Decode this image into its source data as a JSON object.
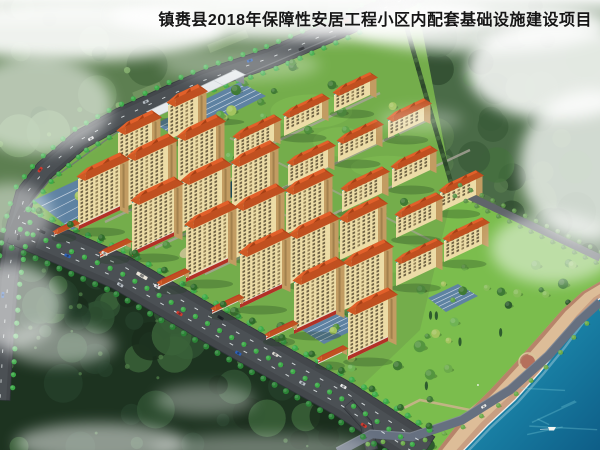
{
  "title": {
    "text": "镇赉县2018年保障性安居工程小区内配套基础设施建设项目"
  },
  "palette": {
    "sky": "#edf1e8",
    "fog": "#ffffff",
    "title_color": "#161616",
    "forest_upper": "#5d7f51",
    "forest_upper_blobs": [
      "#4f7347",
      "#5d8152",
      "#6d9260",
      "#45673e",
      "#79a06a"
    ],
    "forest_right": "#4a6b47",
    "forest_right_blobs": [
      "#3b5c39",
      "#2f4c30",
      "#567b4e",
      "#45703f"
    ],
    "forest_dark": "#1d3320",
    "forest_dark_blobs": [
      "#24402a",
      "#2f5133",
      "#1a2d1c",
      "#3a6138"
    ],
    "terrace": "#91b177",
    "asphalt": "#43474b",
    "asphalt_light": "#54595d",
    "lane": "#e9eef0",
    "street_tree": "#3cab47",
    "street_tree_dark": "#2b8336",
    "lawn": "#74ad4b",
    "lawn_light": "#85c055",
    "park_lawn": "#7cc04e",
    "inner_path": "#aaa59a",
    "tan_path": "#c9b28b",
    "parking": "#5d7fa6",
    "stall": "#d8e0ea",
    "facade": "#ecdca6",
    "facade_end": "#c29c62",
    "window": "#63553a",
    "window_alt": "#8a7850",
    "teal_band": "#2ea396",
    "roof": "#e2602a",
    "roof_side": "#b04518",
    "roof_back": "#c05020",
    "roof_left": "#cf5a24",
    "gable": "#a33f15",
    "podium": "#b23127",
    "shop_roof": "#c23b28",
    "shop_face": "#ded6c8",
    "long_roof": "#e6eaec",
    "long_side": "#9aa0a4",
    "hedge": "#33502f",
    "wall": "#6d7276",
    "water_near": "#5ec7d4",
    "water_mid": "#1a84a8",
    "water_deep": "#0d5a84",
    "sand": "#ddbd98",
    "sand_wet": "#c79b80",
    "sand_top": "#aa725b",
    "shore_road": "#667080",
    "orchard_trees": [
      "#aec973",
      "#93b95c",
      "#c0d687"
    ],
    "site_trees": [
      "#3f7a33",
      "#4f8f3c",
      "#5fa348",
      "#6fb354",
      "#a3c45e"
    ],
    "park_trees": [
      "#3e7a35",
      "#54953f",
      "#6cab4a",
      "#86bd58",
      "#2e5c2e"
    ],
    "car_colors": [
      "#e8e8e8",
      "#d03a2e",
      "#23262b",
      "#2e62b8",
      "#dcd9d2",
      "#b7bec4"
    ]
  },
  "scene": {
    "roads": {
      "main_upper": {
        "path": [
          [
            420,
            -8
          ],
          [
            340,
            28
          ],
          [
            270,
            58
          ],
          [
            205,
            80
          ],
          [
            170,
            95
          ],
          [
            120,
            118
          ],
          [
            80,
            140
          ],
          [
            45,
            170
          ],
          [
            25,
            195
          ],
          [
            16,
            228
          ],
          [
            8,
            280
          ],
          [
            3,
            345
          ],
          [
            0,
            400
          ]
        ],
        "width": 20
      },
      "main_lower": {
        "path": [
          [
            14,
            226
          ],
          [
            120,
            272
          ],
          [
            230,
            336
          ],
          [
            345,
            400
          ],
          [
            425,
            452
          ]
        ],
        "width": 36
      },
      "shore": {
        "path": [
          [
            338,
            452
          ],
          [
            372,
            434
          ],
          [
            412,
            437
          ],
          [
            462,
            420
          ],
          [
            510,
            390
          ],
          [
            548,
            356
          ],
          [
            578,
            322
          ],
          [
            600,
            302
          ]
        ],
        "width": 9
      },
      "orchard": {
        "path": [
          [
            452,
            188
          ],
          [
            520,
            220
          ],
          [
            600,
            258
          ]
        ],
        "width": 7
      },
      "branch": {
        "path": [
          [
            348,
            404
          ],
          [
            366,
            424
          ],
          [
            372,
            450
          ]
        ],
        "width": 12
      }
    },
    "hedge_top": [
      [
        400,
        4
      ],
      [
        430,
        110
      ],
      [
        452,
        186
      ]
    ],
    "wall_line": [
      [
        336,
        36
      ],
      [
        205,
        92
      ],
      [
        120,
        130
      ],
      [
        48,
        182
      ],
      [
        24,
        212
      ]
    ],
    "site_region": [
      [
        415,
        -8
      ],
      [
        340,
        30
      ],
      [
        205,
        82
      ],
      [
        120,
        120
      ],
      [
        45,
        172
      ],
      [
        16,
        226
      ],
      [
        120,
        272
      ],
      [
        230,
        336
      ],
      [
        345,
        400
      ],
      [
        400,
        452
      ],
      [
        470,
        452
      ],
      [
        600,
        296
      ],
      [
        600,
        258
      ],
      [
        500,
        212
      ],
      [
        452,
        186
      ],
      [
        415,
        -8
      ]
    ],
    "forest_upper_poly": [
      [
        0,
        0
      ],
      [
        420,
        0
      ],
      [
        340,
        28
      ],
      [
        205,
        80
      ],
      [
        120,
        118
      ],
      [
        45,
        170
      ],
      [
        16,
        228
      ],
      [
        3,
        345
      ],
      [
        0,
        400
      ]
    ],
    "forest_right_poly": [
      [
        388,
        0
      ],
      [
        600,
        0
      ],
      [
        600,
        256
      ],
      [
        500,
        210
      ],
      [
        452,
        190
      ],
      [
        398,
        4
      ]
    ],
    "forest_dark_poly": [
      [
        0,
        232
      ],
      [
        14,
        236
      ],
      [
        120,
        282
      ],
      [
        230,
        346
      ],
      [
        340,
        412
      ],
      [
        392,
        452
      ],
      [
        0,
        452
      ]
    ],
    "water_shoreline": [
      [
        462,
        452
      ],
      [
        488,
        425
      ],
      [
        515,
        400
      ],
      [
        540,
        372
      ],
      [
        562,
        345
      ],
      [
        582,
        318
      ],
      [
        598,
        300
      ],
      [
        612,
        290
      ]
    ],
    "beach_inner": [
      [
        436,
        452
      ],
      [
        462,
        418
      ],
      [
        490,
        390
      ],
      [
        516,
        362
      ],
      [
        540,
        335
      ],
      [
        562,
        310
      ],
      [
        582,
        292
      ],
      [
        606,
        278
      ]
    ],
    "towers": [
      [
        78,
        230,
        42,
        54,
        1
      ],
      [
        132,
        256,
        42,
        56,
        1
      ],
      [
        186,
        282,
        42,
        58,
        1
      ],
      [
        240,
        308,
        42,
        56,
        1
      ],
      [
        294,
        334,
        42,
        54,
        1
      ],
      [
        348,
        360,
        40,
        50,
        1
      ],
      [
        128,
        206,
        40,
        50,
        0
      ],
      [
        182,
        232,
        40,
        52,
        0
      ],
      [
        236,
        258,
        40,
        52,
        0
      ],
      [
        290,
        284,
        40,
        50,
        0
      ],
      [
        344,
        310,
        40,
        48,
        0
      ],
      [
        178,
        182,
        38,
        46,
        0
      ],
      [
        232,
        208,
        38,
        46,
        0
      ],
      [
        286,
        234,
        38,
        44,
        0
      ],
      [
        340,
        260,
        38,
        42,
        0
      ],
      [
        118,
        170,
        34,
        40,
        0
      ],
      [
        168,
        140,
        30,
        38,
        0
      ]
    ],
    "midrise": [
      [
        234,
        160,
        40,
        24
      ],
      [
        288,
        186,
        40,
        24
      ],
      [
        342,
        212,
        40,
        24
      ],
      [
        396,
        238,
        40,
        24
      ],
      [
        444,
        262,
        38,
        24
      ],
      [
        284,
        136,
        38,
        22
      ],
      [
        338,
        162,
        38,
        22
      ],
      [
        392,
        188,
        38,
        22
      ],
      [
        440,
        212,
        36,
        22
      ],
      [
        334,
        112,
        36,
        20
      ],
      [
        388,
        138,
        36,
        20
      ],
      [
        396,
        286,
        40,
        26
      ]
    ],
    "shops": [
      [
        100,
        258,
        26,
        6
      ],
      [
        158,
        288,
        26,
        6
      ],
      [
        212,
        314,
        26,
        6
      ],
      [
        266,
        340,
        26,
        6
      ],
      [
        318,
        364,
        24,
        6
      ],
      [
        54,
        236,
        20,
        5
      ]
    ],
    "long_building": [
      148,
      120,
      86,
      9
    ],
    "parking_lots": [
      [
        [
          34,
          200
        ],
        [
          86,
          176
        ],
        [
          128,
          198
        ],
        [
          72,
          230
        ]
      ],
      [
        [
          155,
          124
        ],
        [
          240,
          82
        ],
        [
          266,
          96
        ],
        [
          180,
          139
        ]
      ],
      [
        [
          302,
          330
        ],
        [
          338,
          312
        ],
        [
          362,
          326
        ],
        [
          324,
          344
        ]
      ],
      [
        [
          428,
          298
        ],
        [
          458,
          284
        ],
        [
          478,
          296
        ],
        [
          446,
          312
        ]
      ]
    ],
    "inner_paths_u": [
      [
        [
          105,
          222
        ],
        [
          380,
          93
        ]
      ],
      [
        [
          155,
          248
        ],
        [
          430,
          119
        ]
      ],
      [
        [
          205,
          274
        ],
        [
          470,
          150
        ]
      ]
    ],
    "inner_paths_v": [
      [
        [
          130,
          185
        ],
        [
          330,
          286
        ]
      ],
      [
        [
          180,
          162
        ],
        [
          380,
          263
        ]
      ],
      [
        [
          230,
          138
        ],
        [
          430,
          240
        ]
      ]
    ],
    "park_paths": [
      [
        [
          340,
          440
        ],
        [
          420,
          400
        ],
        [
          470,
          410
        ],
        [
          520,
          370
        ]
      ],
      [
        [
          520,
          370
        ],
        [
          555,
          345
        ],
        [
          562,
          330
        ],
        [
          588,
          312
        ]
      ]
    ],
    "pond": {
      "cx": 236,
      "cy": 188,
      "rx": 15,
      "ry": 8,
      "rot": -26
    },
    "plaza": {
      "cx": 528,
      "cy": 362,
      "r": 7
    },
    "boat": {
      "x": 548,
      "y": 428
    },
    "fog_patches": [
      [
        75,
        30,
        150,
        30,
        0.9
      ],
      [
        300,
        16,
        190,
        24,
        0.85
      ],
      [
        480,
        26,
        130,
        26,
        0.8
      ],
      [
        557,
        70,
        90,
        50,
        0.85
      ],
      [
        590,
        165,
        70,
        75,
        0.75
      ],
      [
        553,
        248,
        62,
        36,
        0.5
      ],
      [
        37,
        105,
        75,
        48,
        0.55
      ],
      [
        10,
        215,
        42,
        32,
        0.45
      ],
      [
        8,
        305,
        55,
        42,
        0.55
      ],
      [
        60,
        345,
        55,
        20,
        0.45
      ],
      [
        205,
        400,
        50,
        15,
        0.35
      ],
      [
        100,
        443,
        85,
        20,
        0.5
      ],
      [
        240,
        65,
        80,
        16,
        0.3
      ],
      [
        420,
        120,
        42,
        12,
        0.3
      ],
      [
        260,
        448,
        110,
        14,
        0.35
      ]
    ]
  }
}
